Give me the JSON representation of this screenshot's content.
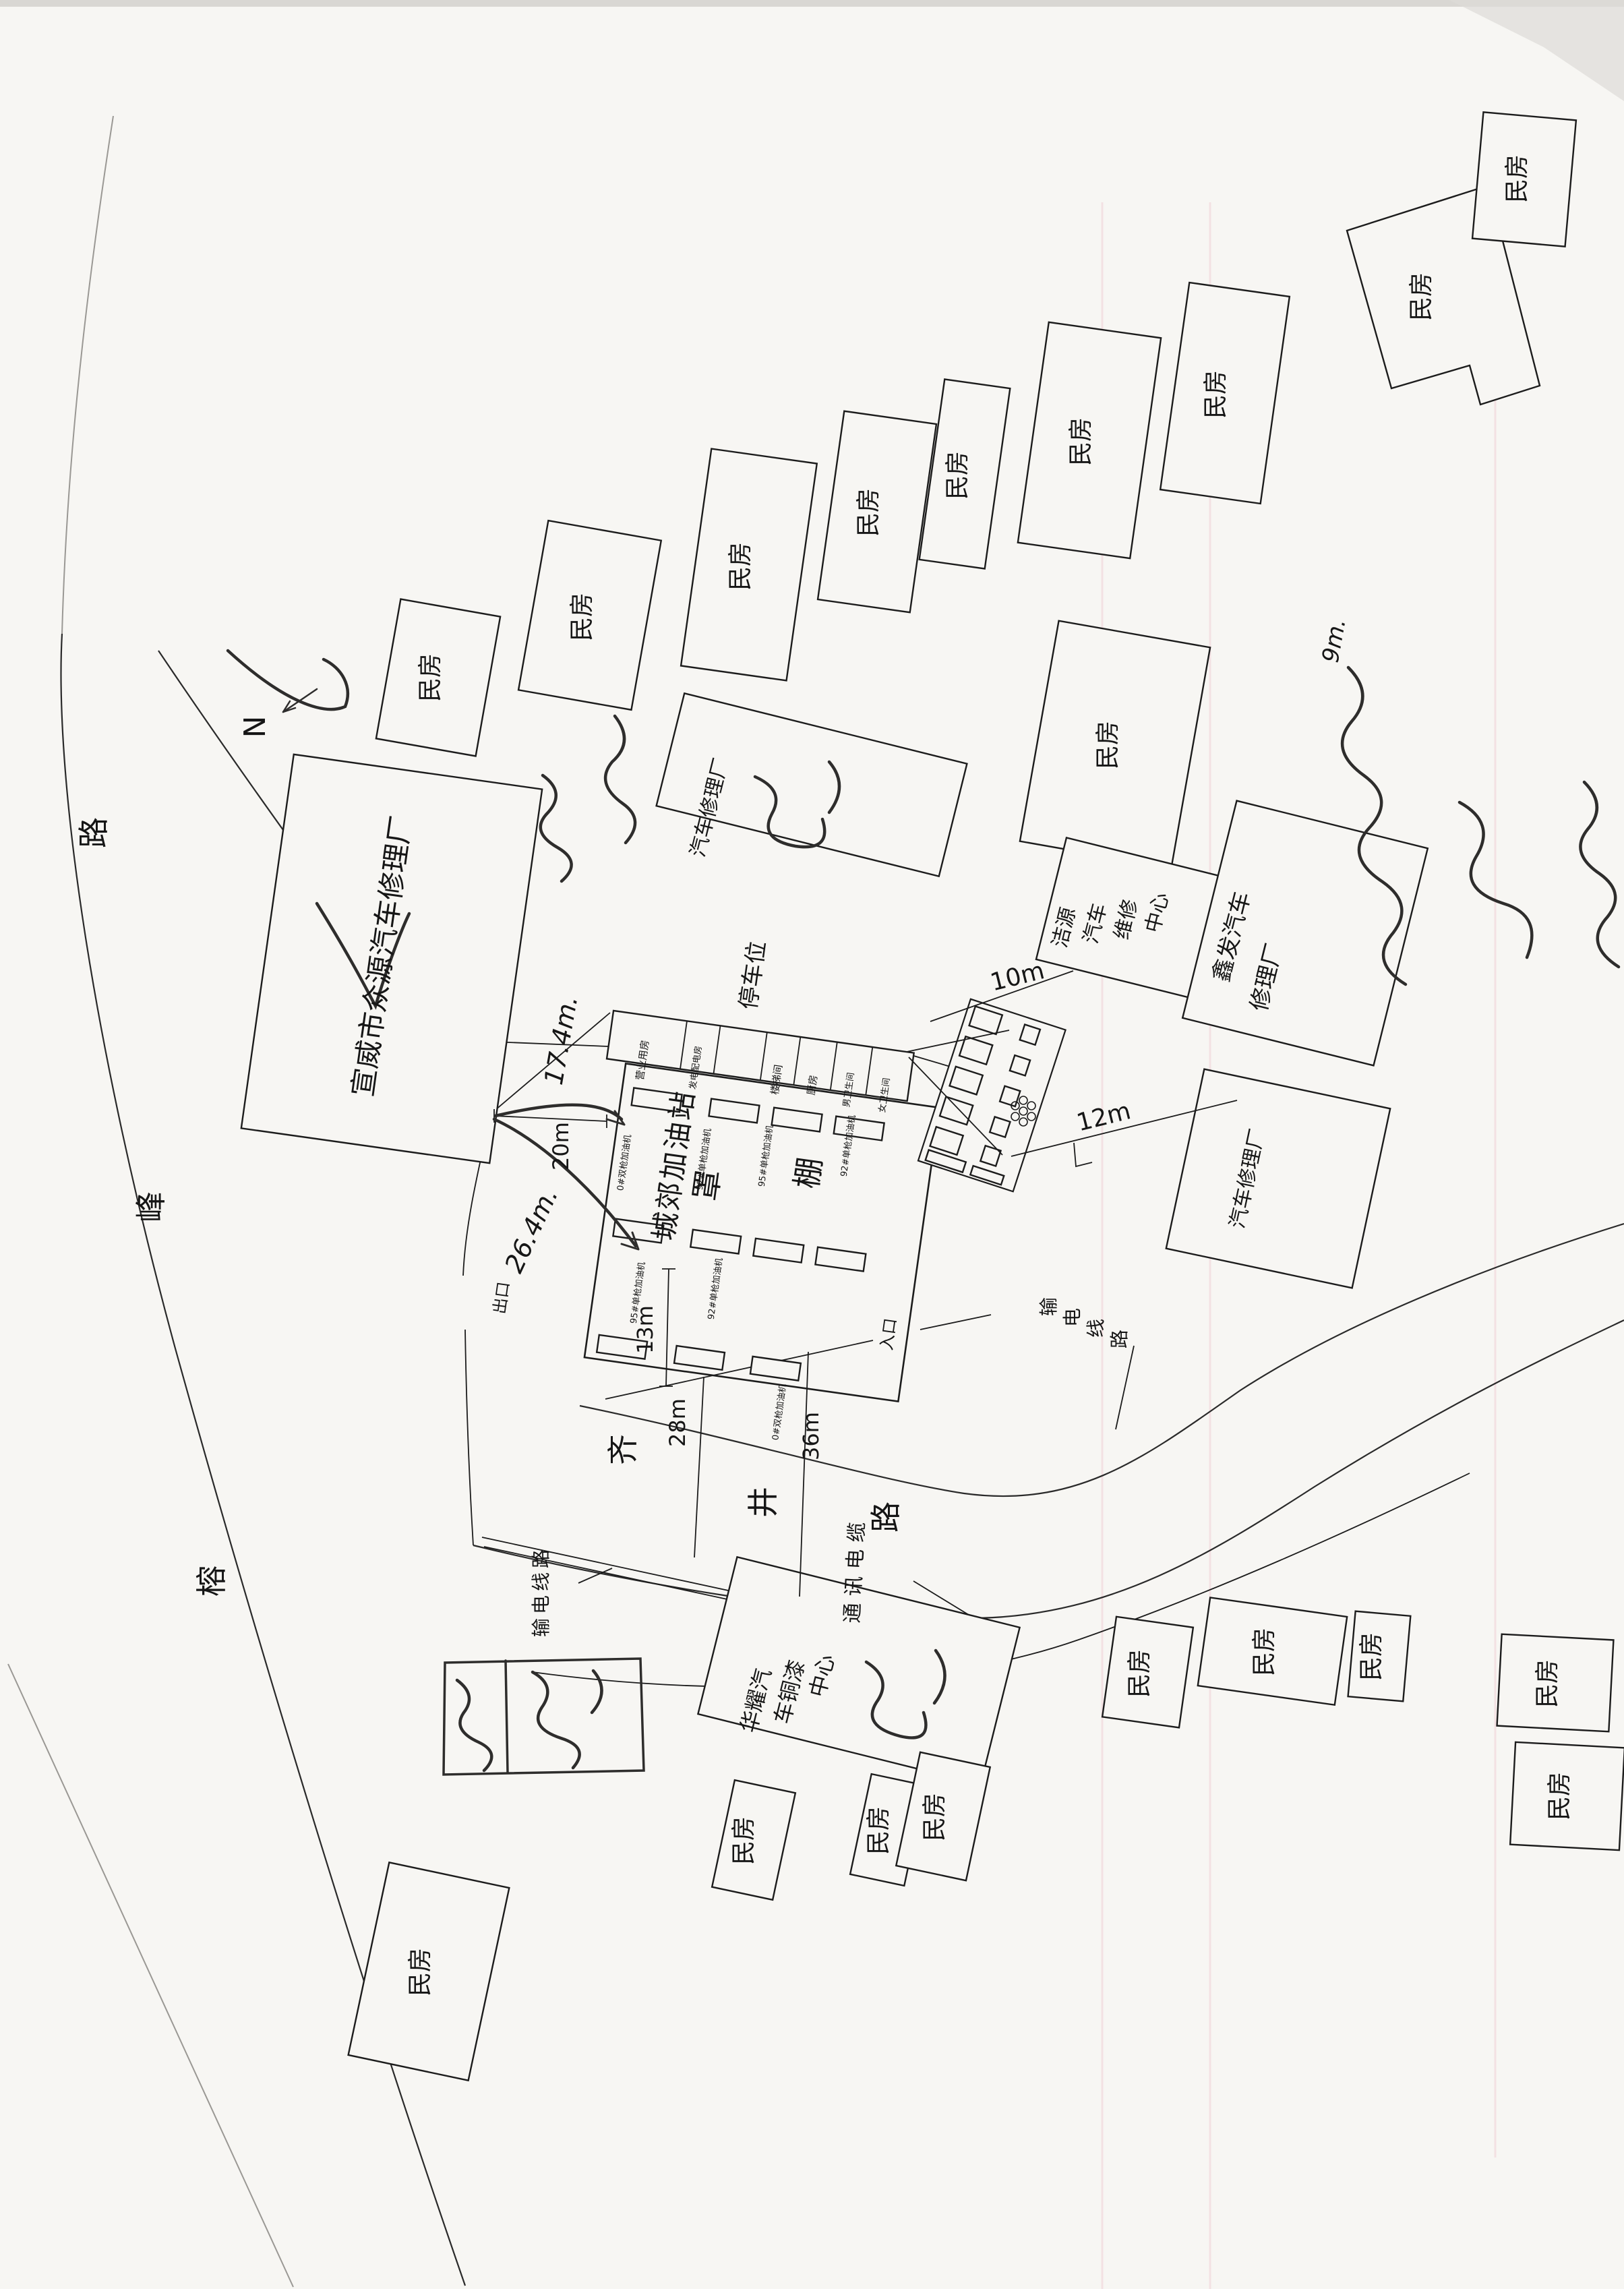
{
  "document": {
    "kind": "scanned hand-drawn site plan"
  },
  "compass": {
    "label": "N"
  },
  "roads": {
    "rongfeng": {
      "name": "榕峰路",
      "chars": [
        "榕",
        "峰",
        "路"
      ]
    },
    "qijing": {
      "name": "齐井路",
      "chars": [
        "齐",
        "井",
        "路"
      ]
    }
  },
  "utilities": {
    "power_line_left": "输电线路",
    "power_line_right_chars": [
      "输",
      "电",
      "线",
      "路"
    ],
    "comm_cable": "通讯电缆"
  },
  "station": {
    "name": "城郊加油站",
    "canopy_char_1": "罩",
    "canopy_char_2": "棚",
    "parking": "停车位",
    "exit": "出口",
    "entrance": "入口",
    "rooms": [
      "营业用房",
      "发电配电房",
      "楼梯间",
      "厨房",
      "男卫生间",
      "女卫生间"
    ],
    "dispensers": {
      "d0": "0#双枪加油机",
      "d92": "92#单枪加油机",
      "d95": "95#单枪加油机"
    }
  },
  "buildings": {
    "minfang": "民房",
    "zhongyuan": "宣威市众源汽车修理厂",
    "top_repair": "汽车修理厂",
    "right_repair": "汽车修理厂",
    "jieyuan_lines": [
      "洁源",
      "汽车",
      "维修",
      "中心"
    ],
    "xinfa_lines": [
      "鑫发汽车",
      "修理厂"
    ],
    "huayao_lines": [
      "华耀汽",
      "车铜漆",
      "中心"
    ]
  },
  "dimensions": {
    "d20": "20m",
    "d13": "13m",
    "d28": "28m",
    "d36": "36m",
    "d10": "10m",
    "d12": "12m"
  },
  "handwritten": {
    "h174": "17.4m.",
    "h264": "26.4m.",
    "h9": "9m."
  }
}
